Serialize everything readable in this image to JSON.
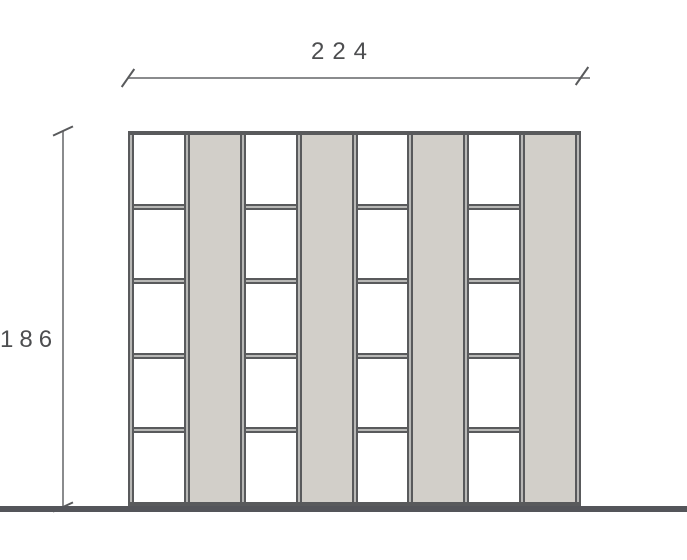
{
  "drawing": {
    "kind": "furniture front elevation",
    "dimensions": {
      "width": {
        "label": "224"
      },
      "height": {
        "label": "186"
      }
    },
    "cabinet": {
      "columns": [
        "open-bay",
        "side-panel",
        "open-bay",
        "side-panel",
        "open-bay",
        "side-panel",
        "open-bay",
        "side-panel"
      ],
      "cells_per_bay": 5
    },
    "colors": {
      "background": "#ffffff",
      "panel_fill": "#d2cfc9",
      "bay_fill": "#ffffff",
      "frame": "#595a5c",
      "frame_core": "#b8b8b6",
      "ground": "#54555a",
      "dim_line": "#8a8b8d",
      "dim_text": "#4d4e50"
    }
  }
}
